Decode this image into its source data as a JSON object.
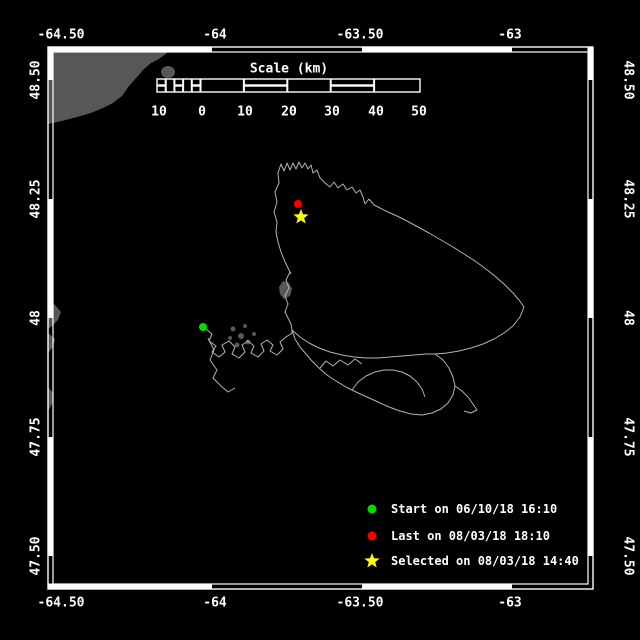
{
  "axes": {
    "lon_labels": [
      "-64.50",
      "-64",
      "-63.50",
      "-63"
    ],
    "lat_labels": [
      "48.50",
      "48.25",
      "48",
      "47.75",
      "47.50"
    ],
    "lon_range": [
      -64.5,
      -63.0
    ],
    "lat_range": [
      47.5,
      48.5
    ]
  },
  "scale_bar": {
    "title": "Scale (km)",
    "ticks": [
      "10",
      "0",
      "10",
      "20",
      "30",
      "40",
      "50"
    ]
  },
  "legend": {
    "items": [
      {
        "marker": "start-dot",
        "shape": "circle",
        "color": "#00dc00",
        "label": "Start on 06/10/18 16:10"
      },
      {
        "marker": "last-dot",
        "shape": "circle",
        "color": "#fa0000",
        "label": "Last on 08/03/18 18:10"
      },
      {
        "marker": "selected-star",
        "shape": "star",
        "color": "#ffff00",
        "label": "Selected on 08/03/18 14:40"
      }
    ]
  },
  "colors": {
    "background": "#000000",
    "frame": "#ffffff",
    "land": "#575757",
    "track": "#b3b3b3",
    "start": "#00dc00",
    "last": "#fa0000",
    "selected": "#ffff00"
  }
}
